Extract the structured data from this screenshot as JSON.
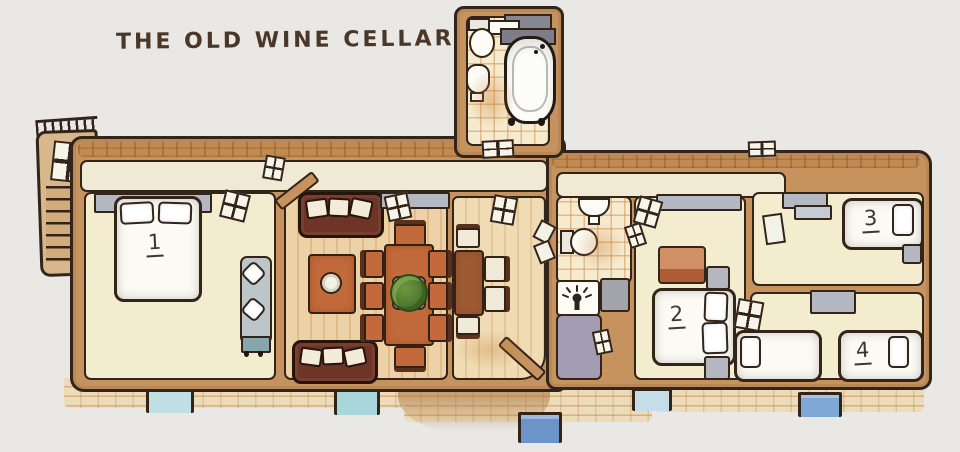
{
  "title": "THE OLD WINE CELLAR",
  "scene": {
    "type": "floor-plan-illustration",
    "style": "hand-drawn watercolor",
    "level_note": "apartment plan drawn above a brick cellar wall with small windows"
  },
  "rooms": {
    "bedroom1": {
      "label": "1",
      "name": "bedroom 1",
      "furniture": [
        "double bed with two pillows",
        "chaise longue"
      ]
    },
    "living_room": {
      "name": "living / dining room",
      "furniture": [
        "two brown sofas",
        "coffee table with bowl",
        "dining table with eight chairs",
        "potted plant"
      ]
    },
    "kitchen": {
      "name": "kitchen / breakfast room",
      "furniture": [
        "table with four chairs"
      ]
    },
    "top_bathroom": {
      "name": "bathroom (top)",
      "furniture": [
        "toilet",
        "washbasin",
        "clawfoot bathtub",
        "shelf"
      ]
    },
    "small_bathroom": {
      "name": "shower room",
      "furniture": [
        "washbasin",
        "toilet",
        "shower",
        "entry mat"
      ]
    },
    "bedroom2": {
      "label": "2",
      "name": "bedroom 2",
      "furniture": [
        "double bed",
        "dresser",
        "two nightstands"
      ]
    },
    "bedroom3": {
      "label": "3",
      "name": "bedroom 3",
      "furniture": [
        "single bed",
        "nightstand"
      ]
    },
    "bedroom4": {
      "label": "4",
      "name": "bedroom 4",
      "furniture": [
        "two single beds"
      ]
    }
  },
  "features": [
    "exterior staircase with railing on the left",
    "corridor along the top",
    "glazed doors and window strips",
    "brick foundation with five cellar windows"
  ],
  "colors": {
    "background": "#e9e8e5",
    "ink": "#332419",
    "wall_tan": "#c6935f",
    "floor_cream": "#f3ecce",
    "floor_wood": "#ecd2a6",
    "tile_line": "#cc8a4a",
    "window_gray": "#b3b8c2",
    "sofa_brown": "#6e3425",
    "terracotta": "#c26a3b",
    "rug_gray": "#a49cb2",
    "plant_green": "#527d31",
    "brick": "#ecdcba",
    "cellar_window_blue": "#6d93cb"
  }
}
